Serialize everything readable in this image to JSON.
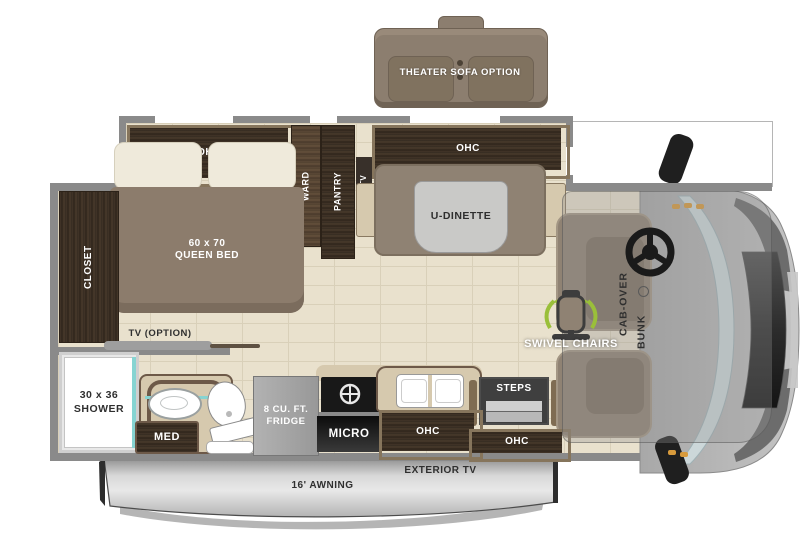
{
  "title": "Class C motorhome floor plan",
  "colors": {
    "floor_tile": "#e9e1cd",
    "dark_wood": "#3a2e22",
    "cabinet_frame": "#86755c",
    "upholstery_taupe": "#8f8273",
    "wall_gray": "#8a8a8a",
    "accent_teal": "#86d4d2",
    "swivel_green": "#9abf3a",
    "awning_silver": "#d6d6d6",
    "appliance_black": "#181818",
    "label_white": "#ffffff",
    "label_dark": "#2f2f2f"
  },
  "icons": {
    "steering_wheel": "steering-wheel-icon",
    "swivel_chair": "swivel-chair-icon",
    "burner": "burner-icon",
    "sink": "sink-icon",
    "toilet": "toilet-icon",
    "side_mirror": "side-mirror-icon"
  },
  "floorplan": {
    "theater_sofa": {
      "label": "THEATER SOFA OPTION"
    },
    "slideout": {
      "ohc_left": "OHC",
      "ward": "WARD",
      "pantry": "PANTRY",
      "tv": "TV",
      "ohc_right": "OHC"
    },
    "bedroom": {
      "bed_size": "60 x 70",
      "bed_type": "QUEEN BED",
      "closet": "CLOSET",
      "tv_option": "TV (OPTION)"
    },
    "dinette": {
      "label": "U-DINETTE"
    },
    "bathroom": {
      "shower_size": "30 x 36",
      "shower_label": "SHOWER",
      "med": "MED"
    },
    "kitchen": {
      "fridge_line1": "8 CU. FT.",
      "fridge_line2": "FRIDGE",
      "micro": "MICRO",
      "ohc": "OHC"
    },
    "entry": {
      "steps": "STEPS",
      "ohc": "OHC"
    },
    "cab": {
      "swivel_chairs": "SWIVEL CHAIRS",
      "cab_over_line1": "CAB-OVER",
      "cab_over_line2": "BUNK"
    },
    "exterior": {
      "exterior_tv": "EXTERIOR TV",
      "awning": "16' AWNING"
    }
  }
}
